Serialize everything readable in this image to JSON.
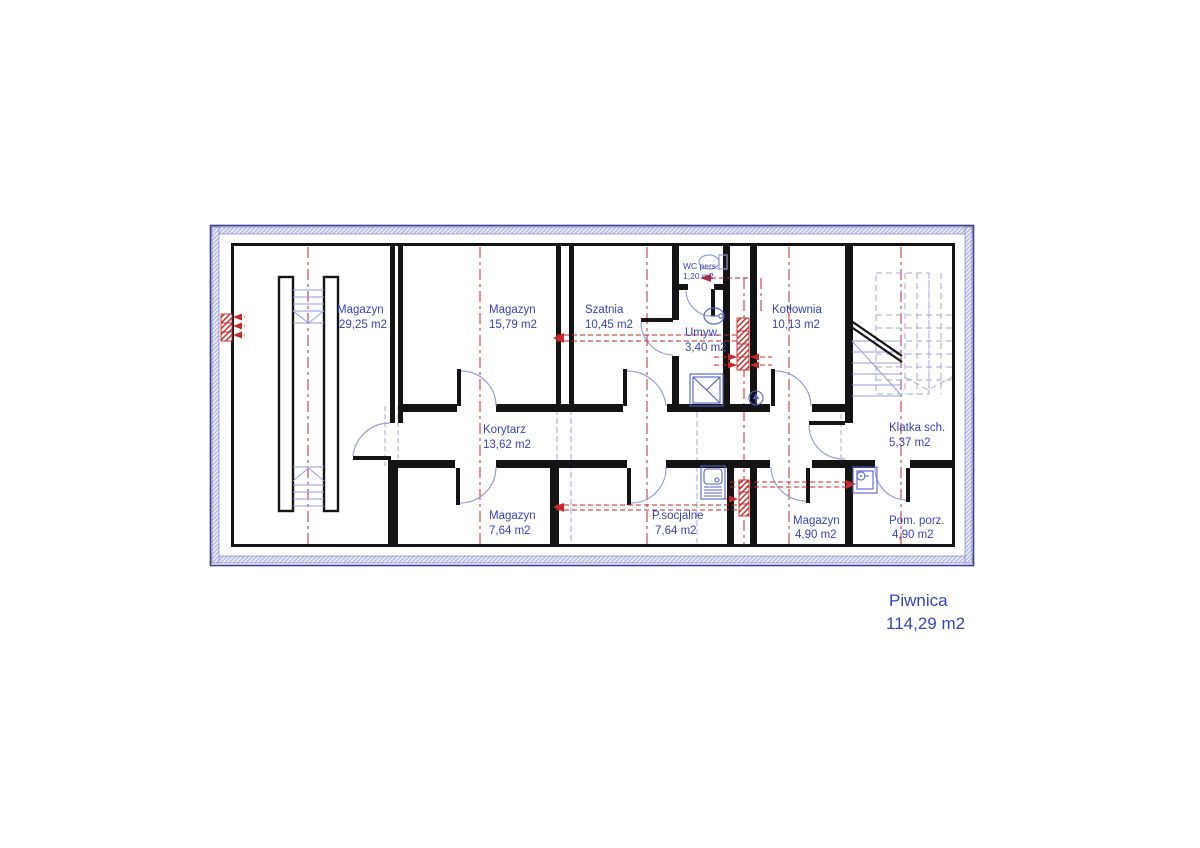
{
  "plan": {
    "drawing_title": "Piwnica",
    "drawing_area": "114,29 m2",
    "rooms": [
      {
        "name": "Magazyn",
        "area": "29,25 m2"
      },
      {
        "name": "Magazyn",
        "area": "15,79 m2"
      },
      {
        "name": "Szatnia",
        "area": "10,45 m2"
      },
      {
        "name": "WC pers.",
        "area": "1,20 m2"
      },
      {
        "name": "Umyw.",
        "area": "3,40 m2"
      },
      {
        "name": "Kotłownia",
        "area": "10,13 m2"
      },
      {
        "name": "Korytarz",
        "area": "13,62 m2"
      },
      {
        "name": "Klatka sch.",
        "area": "5,37 m2"
      },
      {
        "name": "Magazyn",
        "area": "7,64 m2"
      },
      {
        "name": "P.socjalne",
        "area": "7,64 m2"
      },
      {
        "name": "Magazyn",
        "area": "4,90 m2"
      },
      {
        "name": "Pom. porz.",
        "area": "4,90 m2"
      }
    ],
    "icons": [
      "toilet-icon",
      "washbasin-icon",
      "shower-icon",
      "floor-drain-icon",
      "sink-unit-icon",
      "janitor-sink-icon",
      "stairs-icon",
      "ramp-stairs-icon",
      "vent-chimney-icon"
    ],
    "colors": {
      "label_blue": "#3742bf",
      "fixture_blue": "#5560c8",
      "swing_blue": "#959ed8",
      "projection_blue": "#a3aad6",
      "axis_red": "#c62a2a",
      "wall_black": "#141414",
      "exterior_band": "#bcc0ea",
      "exterior_edge": "#3a3f8f"
    }
  }
}
